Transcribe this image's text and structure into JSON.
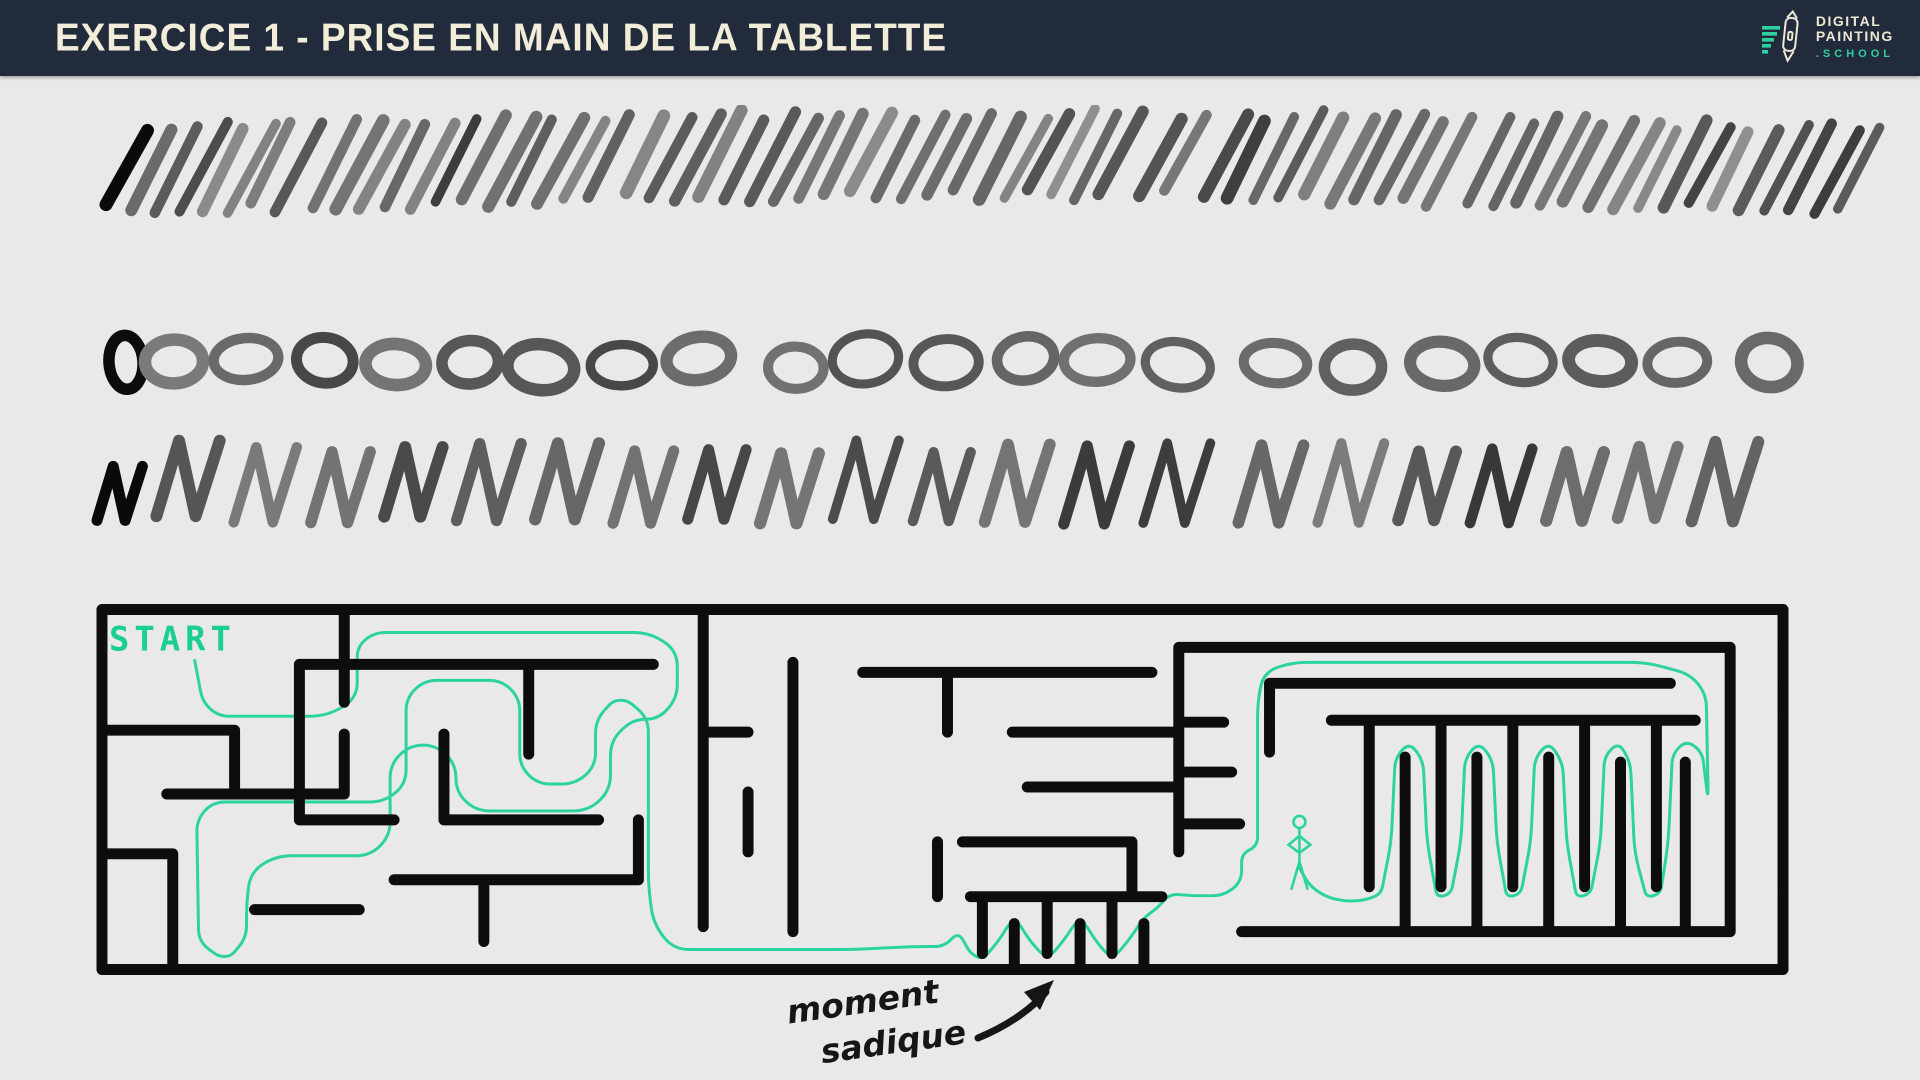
{
  "header": {
    "title": "EXERCICE 1 - PRISE EN MAIN DE LA TABLETTE",
    "logo": {
      "word1": "DIGITAL",
      "word2": "PAINTING",
      "word3": ".SCHOOL"
    }
  },
  "colors": {
    "header_bg": "#212b3c",
    "title_cream": "#f2edd8",
    "accent_green": "#2fd0a0",
    "canvas_bg": "#e9e9e9",
    "ink": "#0d0d0d",
    "path_green": "#2bd3a0",
    "start_green": "#1bcf90"
  },
  "drawing": {
    "slash_row": {
      "count": 68,
      "first_color": "#0a0a0a"
    },
    "oval_row": {
      "count": 22,
      "first_color": "#0c0c0c"
    },
    "n_row": {
      "count": 22,
      "first_color": "#0a0a0a"
    }
  },
  "maze": {
    "start_label": "START",
    "annotation": {
      "word1": "moment",
      "word2": "sadique"
    }
  }
}
